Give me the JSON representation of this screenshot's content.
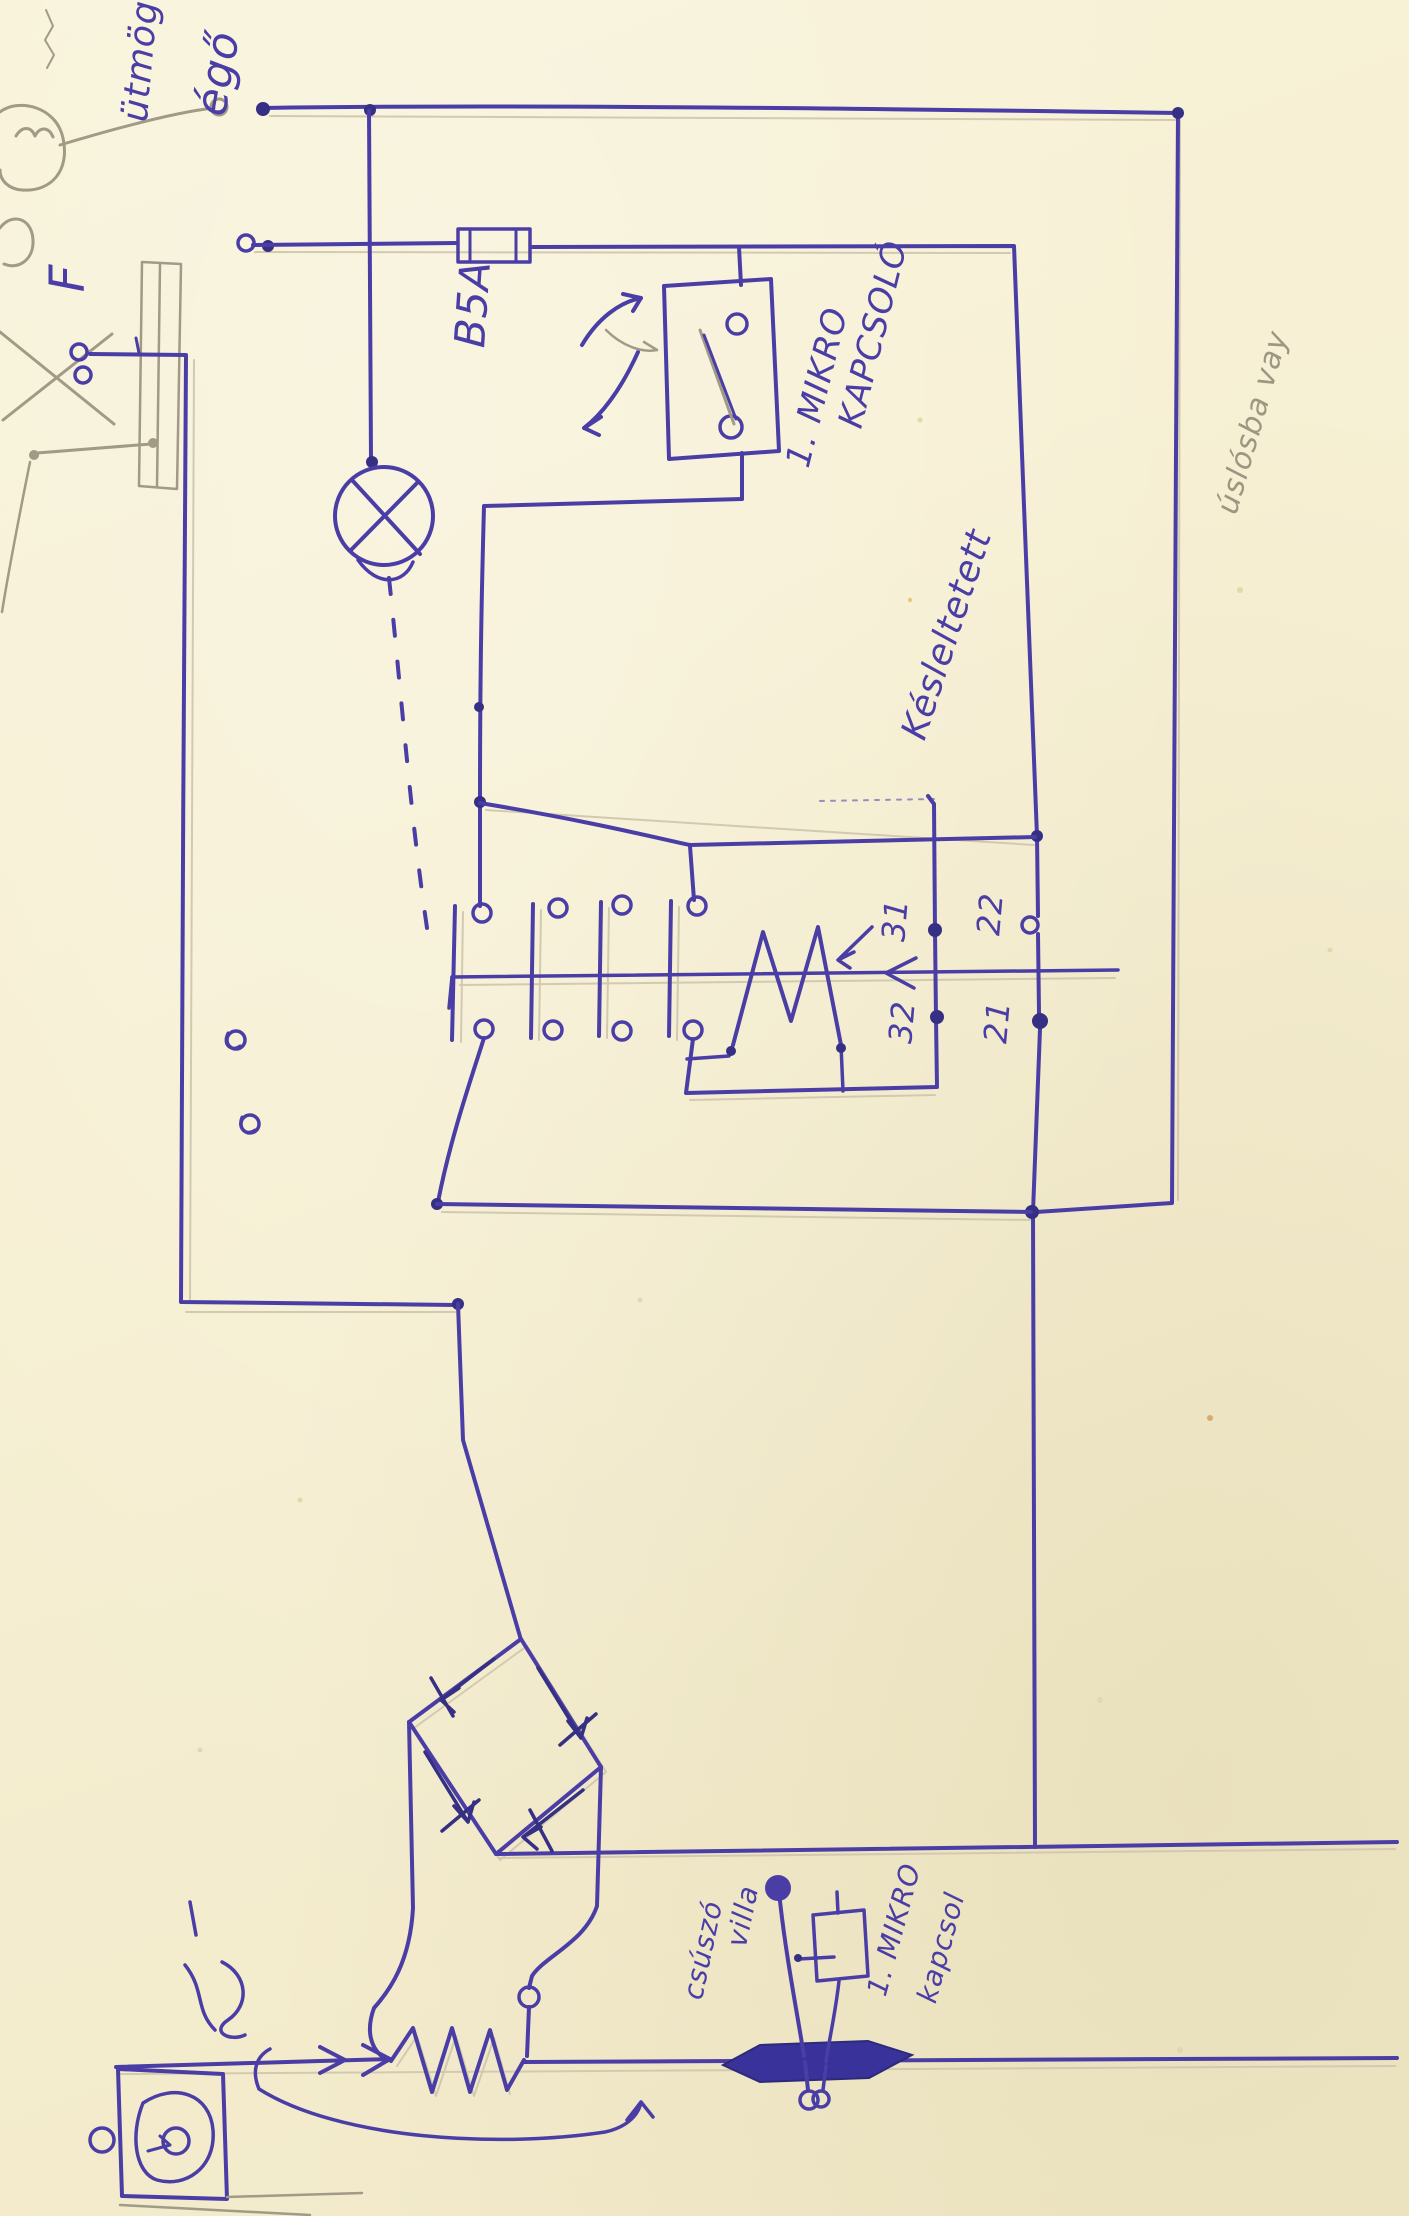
{
  "document": {
    "kind": "hand-drawn electrical schematic",
    "medium": "blue ballpoint pen with pencil underdrawing on cream paper",
    "orientation": "landscape drawing scanned in portrait, labels rotated 90°"
  },
  "colors": {
    "paper": "#f6efd2",
    "ink": "#4a3ea6",
    "ink_dark": "#353083",
    "pencil": "#a09a86"
  },
  "labels": {
    "note_top_word1": "ütmög",
    "note_top_word2": "égő",
    "terminal_f": "F",
    "fuse_rating": "B5A",
    "micro_switch_line1": "1. MIKRO",
    "micro_switch_line2": "KAPCSOLÓ",
    "delay_label": "Késleltetett",
    "contact_31": "31",
    "contact_32": "32",
    "contact_22": "22",
    "contact_21": "21",
    "slider_line1": "csúszó",
    "slider_line2": "villa",
    "bottom_switch_line1": "1. MIKRO",
    "bottom_switch_line2": "kapcsol",
    "pencil_note": "úslósba vay"
  },
  "symbols": {
    "plug_sketch": "mains-plug-and-switch-pencil-sketch",
    "lamp": "indicator-lamp-circle-x",
    "fuse": "fuse-cartridge",
    "micro_switch": "micro-switch-box",
    "contact_bank": "four-pole-relay-contact-bank",
    "relay_coil": "relay-coil-zigzag-M",
    "bridge": "diode-bridge-rectifier",
    "resistor": "slide-wire-resistor",
    "slider": "sliding-contact-dark-arrow",
    "motor": "motor-pump-box"
  }
}
